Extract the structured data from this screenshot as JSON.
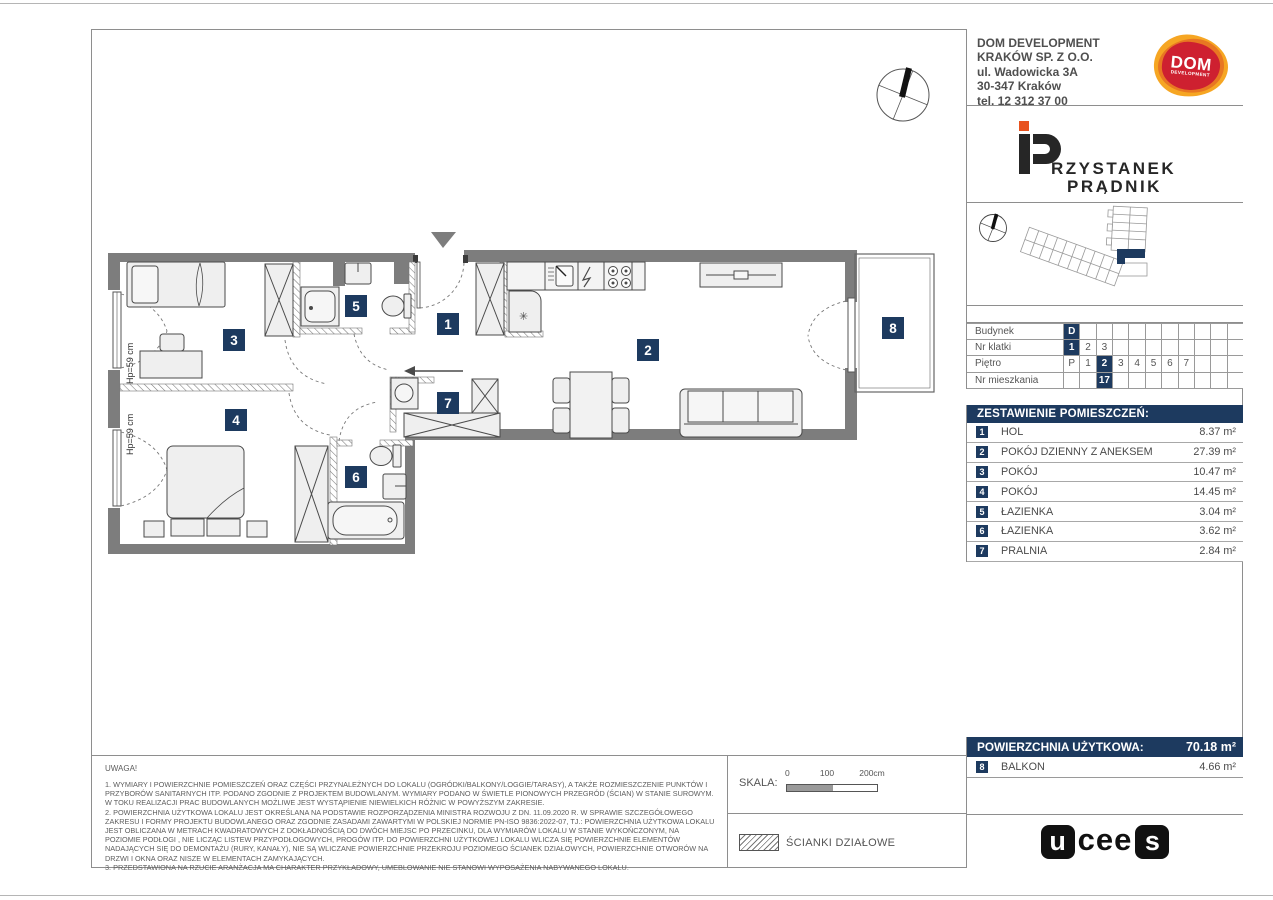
{
  "colors": {
    "navy": "#1d3a5f",
    "wall": "#7d7d7d",
    "orange": "#e87722",
    "red": "#ce2030"
  },
  "header": {
    "company_lines": [
      "DOM DEVELOPMENT",
      "KRAKÓW SP. Z O.O.",
      "ul. Wadowicka 3A",
      "30-347 Kraków",
      "tel. 12 312 37 00"
    ],
    "dom_logo": {
      "word": "DOM",
      "sub": "DEVELOPMENT"
    },
    "project_logo": {
      "p": "P",
      "line1": "RZYSTANEK",
      "line2": "PRĄDNIK"
    }
  },
  "info_table": {
    "rows": [
      {
        "label": "Budynek",
        "cells": [
          "D",
          "",
          "",
          "",
          "",
          "",
          "",
          "",
          "",
          "",
          ""
        ],
        "highlight": [
          0
        ]
      },
      {
        "label": "Nr klatki",
        "cells": [
          "1",
          "2",
          "3",
          "",
          "",
          "",
          "",
          "",
          "",
          "",
          ""
        ],
        "highlight": [
          0
        ]
      },
      {
        "label": "Piętro",
        "cells": [
          "P",
          "1",
          "2",
          "3",
          "4",
          "5",
          "6",
          "7",
          "",
          "",
          ""
        ],
        "highlight": [
          2
        ]
      },
      {
        "label": "Nr mieszkania",
        "cells": [
          "",
          "",
          "17",
          "",
          "",
          "",
          "",
          "",
          "",
          "",
          ""
        ],
        "highlight": [
          2
        ]
      }
    ]
  },
  "rooms": {
    "title": "ZESTAWIENIE POMIESZCZEŃ:",
    "items": [
      {
        "no": "1",
        "name": "HOL",
        "area": "8.37 m²"
      },
      {
        "no": "2",
        "name": "POKÓJ DZIENNY Z ANEKSEM",
        "area": "27.39 m²"
      },
      {
        "no": "3",
        "name": "POKÓJ",
        "area": "10.47 m²"
      },
      {
        "no": "4",
        "name": "POKÓJ",
        "area": "14.45 m²"
      },
      {
        "no": "5",
        "name": "ŁAZIENKA",
        "area": "3.04 m²"
      },
      {
        "no": "6",
        "name": "ŁAZIENKA",
        "area": "3.62 m²"
      },
      {
        "no": "7",
        "name": "PRALNIA",
        "area": "2.84 m²"
      }
    ]
  },
  "summary": {
    "total_label": "POWIERZCHNIA UŻYTKOWA:",
    "total_value": "70.18 m²",
    "balcony": {
      "no": "8",
      "name": "BALKON",
      "area": "4.66 m²"
    }
  },
  "plan": {
    "badges": [
      "1",
      "2",
      "3",
      "4",
      "5",
      "6",
      "7",
      "8"
    ],
    "hp_labels": [
      "Hp=59 cm",
      "Hp=59 cm"
    ],
    "fridge_glyph": "✳"
  },
  "scale": {
    "label": "SKALA:",
    "ticks": [
      "0",
      "100",
      "200cm"
    ]
  },
  "legend": {
    "partition_label": "ŚCIANKI DZIAŁOWE"
  },
  "notes": {
    "title": "UWAGA!",
    "items": [
      "1. WYMIARY I POWIERZCHNIE POMIESZCZEŃ ORAZ CZĘŚCI PRZYNALEŻNYCH DO LOKALU (OGRÓDKI/BALKONY/LOGGIE/TARASY), A TAKŻE ROZMIESZCZENIE PUNKTÓW I PRZYBORÓW SANITARNYCH ITP. PODANO ZGODNIE Z PROJEKTEM BUDOWLANYM. WYMIARY PODANO W ŚWIETLE PIONOWYCH PRZEGRÓD (ŚCIAN) W STANIE SUROWYM. W TOKU REALIZACJI PRAC BUDOWLANYCH MOŻLIWE JEST WYSTĄPIENIE NIEWIELKICH RÓŻNIC W POWYŻSZYM ZAKRESIE.",
      "2. POWIERZCHNIA UŻYTKOWA LOKALU JEST OKREŚLANA NA PODSTAWIE ROZPORZĄDZENIA MINISTRA ROZWOJU Z DN. 11.09.2020 R. W SPRAWIE SZCZEGÓŁOWEGO ZAKRESU I FORMY PROJEKTU BUDOWLANEGO ORAZ ZGODNIE ZASADAMI ZAWARTYMI W POLSKIEJ NORMIE PN-ISO 9836:2022-07, TJ.: POWIERZCHNIA UŻYTKOWA LOKALU JEST OBLICZANA W METRACH KWADRATOWYCH Z DOKŁADNOŚCIĄ DO DWÓCH MIEJSC PO PRZECINKU, DLA WYMIARÓW LOKALU W STANIE WYKOŃCZONYM, NA POZIOMIE PODŁOGI , NIE LICZĄC LISTEW PRZYPODŁOGOWYCH, PROGÓW ITP. DO POWIERZCHNI UŻYTKOWEJ LOKALU WLICZA SIĘ POWIERZCHNIE ELEMENTÓW NADAJĄCYCH SIĘ DO DEMONTAŻU (RURY, KANAŁY), NIE SĄ WLICZANE POWIERZCHNIE PRZEKROJU POZIOMEGO ŚCIANEK DZIAŁOWYCH, POWIERZCHNIE OTWORÓW NA DRZWI I OKNA ORAZ NISZE W ELEMENTACH ZAMYKAJĄCYCH.",
      "3. PRZEDSTAWIONA NA RZUCIE ARANŻACJA MA CHARAKTER PRZYKŁADOWY, UMEBLOWANIE NIE STANOWI WYPOSAŻENIA NABYWANEGO LOKALU."
    ]
  },
  "footer_logo": {
    "u": "u",
    "cee": "cee",
    "s": "s"
  }
}
